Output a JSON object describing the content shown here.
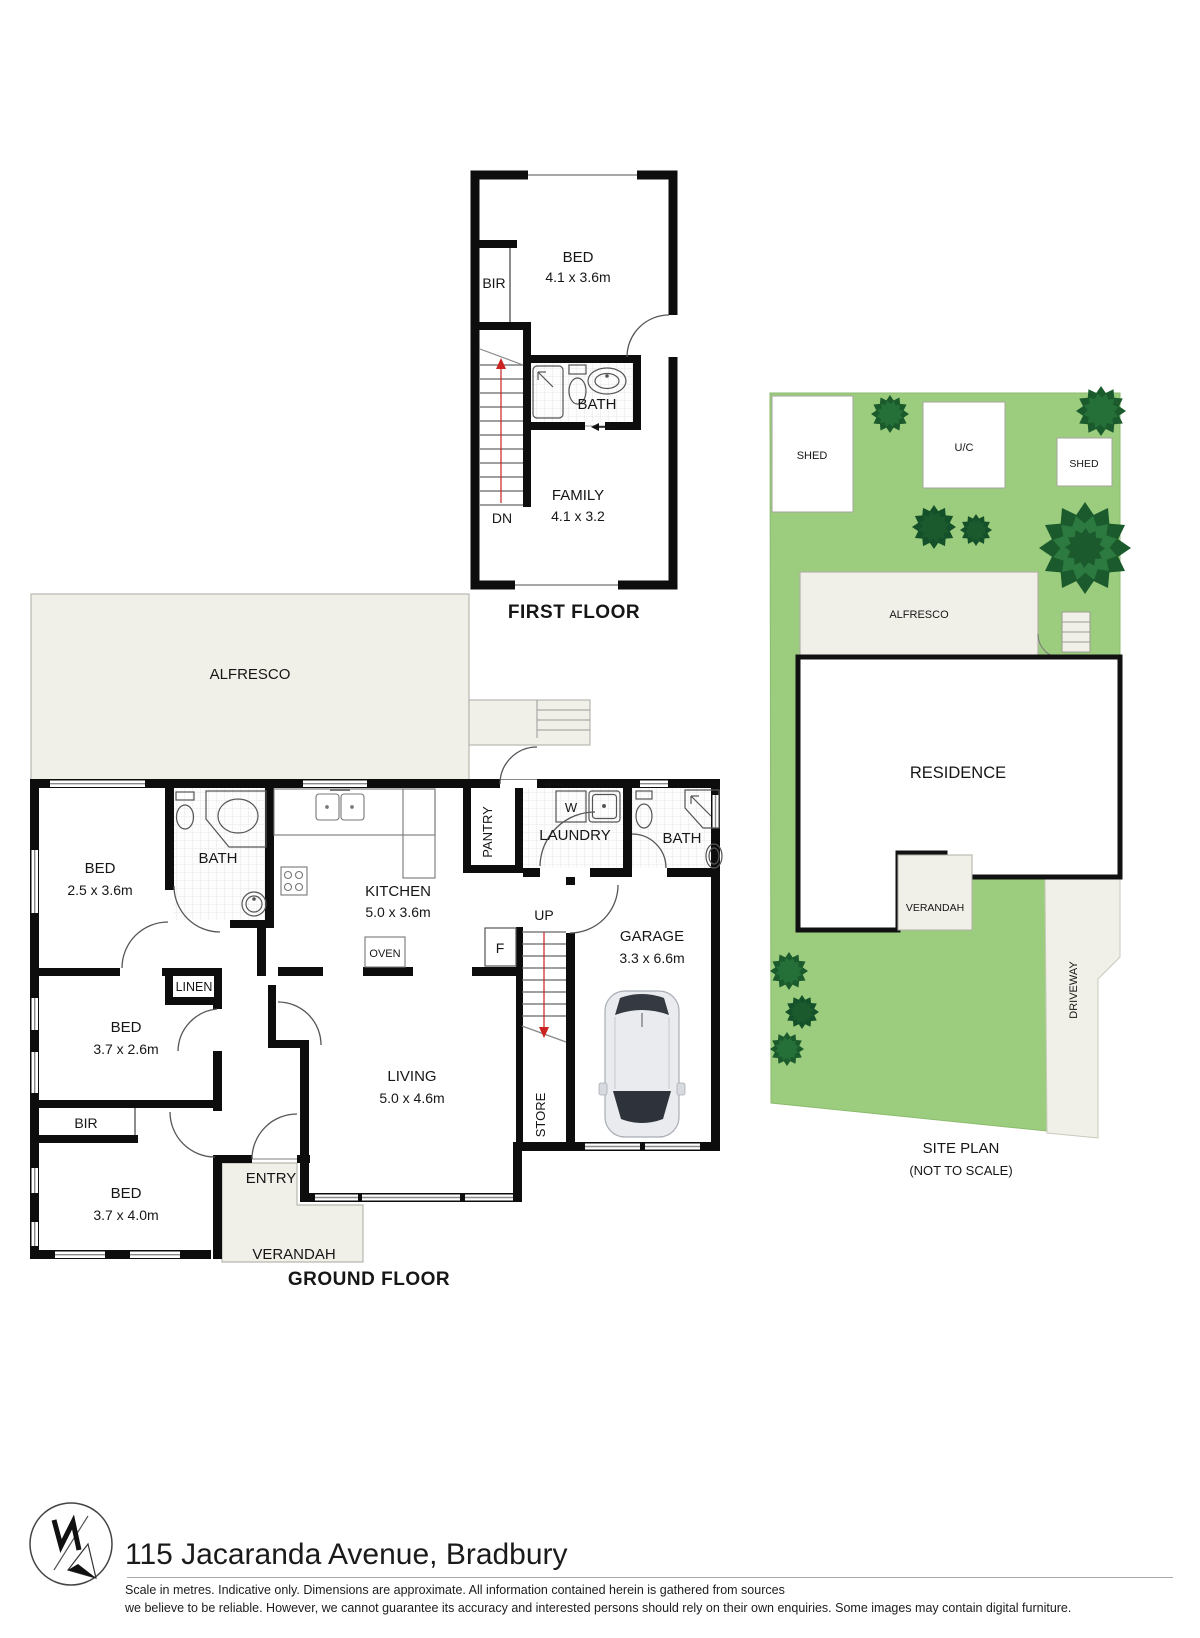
{
  "first_floor": {
    "title": "FIRST FLOOR",
    "bed_label": "BED",
    "bed_dims": "4.1 x 3.6m",
    "bir_label": "BIR",
    "bath_label": "BATH",
    "family_label": "FAMILY",
    "family_dims": "4.1 x 3.2",
    "stairs_label": "DN"
  },
  "ground_floor": {
    "title": "GROUND FLOOR",
    "alfresco_label": "ALFRESCO",
    "bed1_label": "BED",
    "bed1_dims": "2.5 x 3.6m",
    "bath1_label": "BATH",
    "kitchen_label": "KITCHEN",
    "kitchen_dims": "5.0 x 3.6m",
    "oven_label": "OVEN",
    "pantry_label": "PANTRY",
    "laundry_label": "LAUNDRY",
    "washer_label": "W",
    "bath2_label": "BATH",
    "garage_label": "GARAGE",
    "garage_dims": "3.3 x 6.6m",
    "stairs_label": "UP",
    "fridge_label": "F",
    "store_label": "STORE",
    "living_label": "LIVING",
    "living_dims": "5.0 x 4.6m",
    "linen_label": "LINEN",
    "bed2_label": "BED",
    "bed2_dims": "3.7 x 2.6m",
    "bir_label": "BIR",
    "bed3_label": "BED",
    "bed3_dims": "3.7 x 4.0m",
    "entry_label": "ENTRY",
    "verandah_label": "VERANDAH"
  },
  "site_plan": {
    "title": "SITE PLAN",
    "subtitle": "(NOT TO SCALE)",
    "shed_left_label": "SHED",
    "uc_label": "U/C",
    "shed_right_label": "SHED",
    "alfresco_label": "ALFRESCO",
    "residence_label": "RESIDENCE",
    "verandah_label": "VERANDAH",
    "driveway_label": "DRIVEWAY"
  },
  "footer": {
    "address": "115 Jacaranda Avenue, Bradbury",
    "disclaimer_line1": "Scale in metres. Indicative only. Dimensions are approximate. All information contained herein is gathered from sources",
    "disclaimer_line2": "we believe to be reliable. However, we cannot guarantee its accuracy and interested persons should rely on their own enquiries. Some images may contain digital furniture.",
    "logo_icon": "compass-north-icon"
  },
  "colors": {
    "wall": "#0d0d0d",
    "paving": "#f1f0e8",
    "grass": "#9ccd7e",
    "tree": "#1b5a2c",
    "tree_light": "#247038",
    "stair_arrow": "#cc2222"
  }
}
